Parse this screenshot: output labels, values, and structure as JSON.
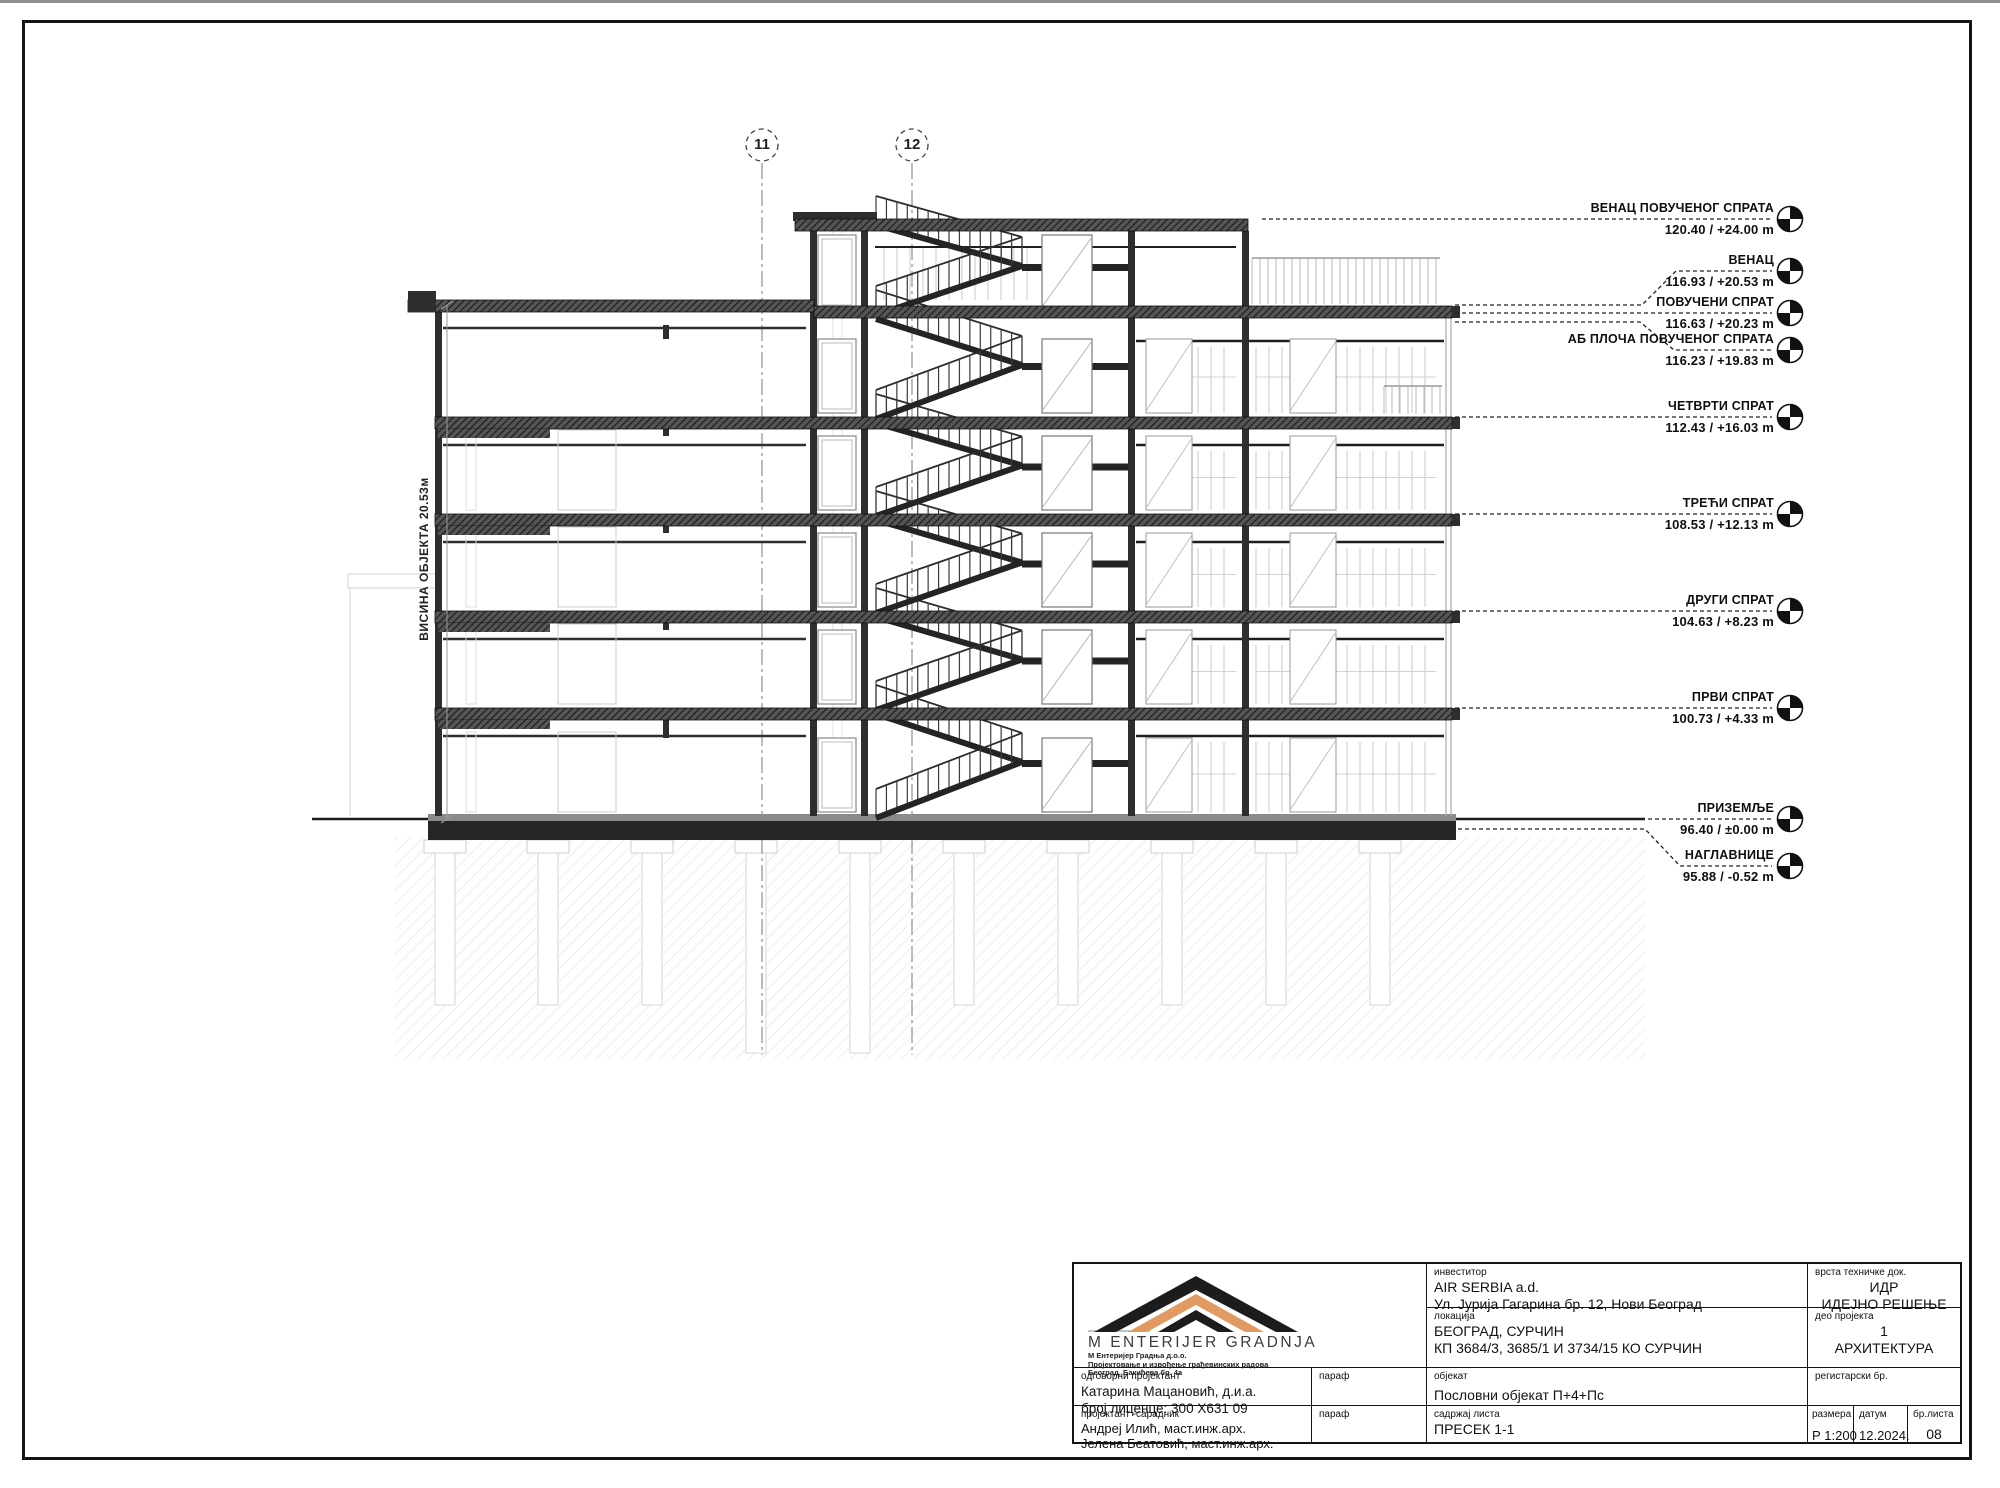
{
  "drawing": {
    "height_label": "ВИСИНА ОБЈЕКТА  20.53м",
    "section_markers": [
      {
        "id": "11"
      },
      {
        "id": "12"
      }
    ]
  },
  "levels": [
    {
      "name": "ВЕНАЦ ПОВУЧЕНОГ СПРАТА",
      "value": "120.40 / +24.00 m"
    },
    {
      "name": "ВЕНАЦ",
      "value": "116.93 / +20.53 m"
    },
    {
      "name": "ПОВУЧЕНИ СПРАТ",
      "value": "116.63 / +20.23 m"
    },
    {
      "name": "АБ ПЛОЧА ПОВУЧЕНОГ СПРАТА",
      "value": "116.23 / +19.83 m"
    },
    {
      "name": "ЧЕТВРТИ СПРАТ",
      "value": "112.43 / +16.03 m"
    },
    {
      "name": "ТРЕЋИ СПРАТ",
      "value": "108.53 / +12.13 m"
    },
    {
      "name": "ДРУГИ СПРАТ",
      "value": "104.63 / +8.23 m"
    },
    {
      "name": "ПРВИ СПРАТ",
      "value": "100.73 / +4.33 m"
    },
    {
      "name": "ПРИЗЕМЉЕ",
      "value": "96.40 / ±0.00 m"
    },
    {
      "name": "НАГЛАВНИЦЕ",
      "value": "95.88 / -0.52 m"
    }
  ],
  "title_block": {
    "company": {
      "name": "M  ENTERIJER  GRADNJA",
      "line1": "М Ентеријер Градња д.о.о.",
      "line2": "Пројектовање и извођење грађевинских радова",
      "line3": "Београд, Бакићева бр. 4а"
    },
    "investor": {
      "label": "инвеститор",
      "line1": "AIR SERBIA a.d.",
      "line2": "Ул. Јурија Гагарина бр. 12, Нови Београд"
    },
    "location": {
      "label": "локација",
      "line1": "БЕОГРАД, СУРЧИН",
      "line2": "КП 3684/3, 3685/1 И 3734/15 КО СУРЧИН"
    },
    "doc_type": {
      "label": "врста техничке док.",
      "line1": "ИДР",
      "line2": "ИДЕЈНО РЕШЕЊЕ"
    },
    "project_part": {
      "label": "део пројекта",
      "num": "1",
      "name": "АРХИТЕКТУРА"
    },
    "lead_designer": {
      "label": "одговорни пројектант",
      "name": "Катарина Мацановић, д.и.а.",
      "license": "број лиценце: 300 X631 09"
    },
    "paraf_label": "параф",
    "object": {
      "label": "објекат",
      "value": "Пословни објекат П+4+Пс"
    },
    "registry": {
      "label": "регистарски бр."
    },
    "collaborator": {
      "label": "пројектант -сарадник",
      "name1": "Андреј Илић, маст.инж.арх.",
      "name2": "Јелена Беатовић, маст.инж.арх."
    },
    "sheet_content": {
      "label": "садржај листа",
      "value": "ПРЕСЕК 1-1"
    },
    "scale": {
      "label": "размера",
      "value": "Р 1:200"
    },
    "date": {
      "label": "датум",
      "value": "12.2024."
    },
    "sheet_no": {
      "label": "бр.листа",
      "value": "08"
    }
  }
}
